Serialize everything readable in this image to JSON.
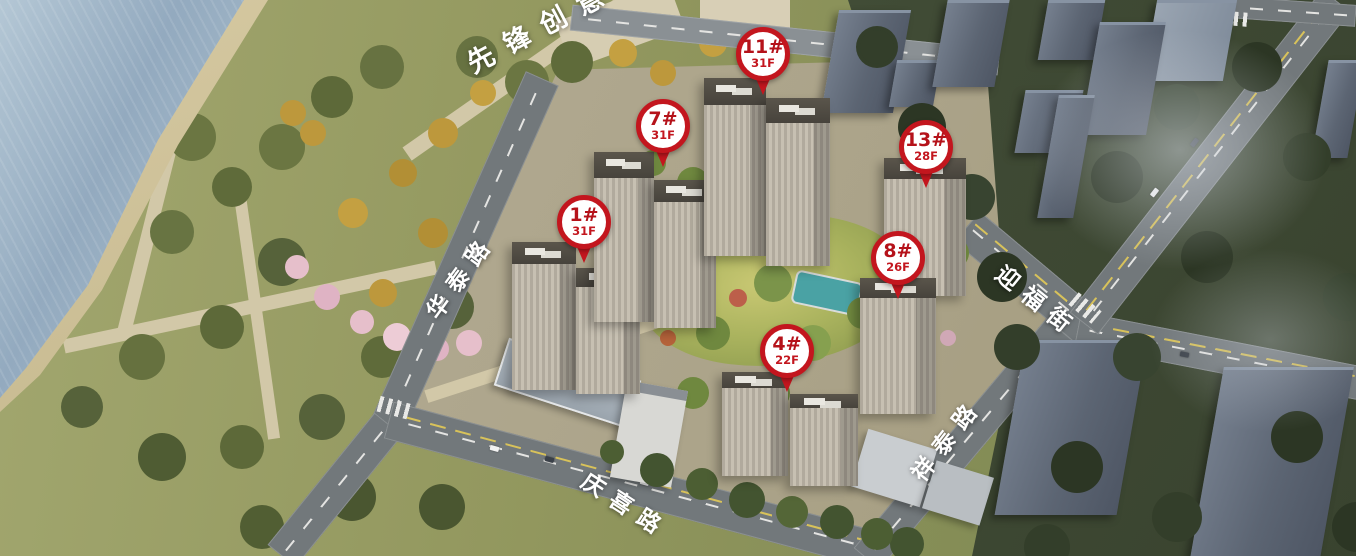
{
  "scene": {
    "park_label": "先锋创意",
    "roads": [
      {
        "name": "华泰路"
      },
      {
        "name": "庆喜路"
      },
      {
        "name": "祥泰路"
      },
      {
        "name": "迎福街"
      }
    ],
    "pins": [
      {
        "building": "1#",
        "floors": "31F"
      },
      {
        "building": "4#",
        "floors": "22F"
      },
      {
        "building": "7#",
        "floors": "31F"
      },
      {
        "building": "8#",
        "floors": "26F"
      },
      {
        "building": "11#",
        "floors": "31F"
      },
      {
        "building": "13#",
        "floors": "28F"
      }
    ],
    "colors": {
      "pin_red": "#c3161e",
      "pin_white": "#ffffff",
      "water_blue": "#9bb2c6",
      "park_green": "#8d935f",
      "city_slate": "#5c6573"
    }
  }
}
